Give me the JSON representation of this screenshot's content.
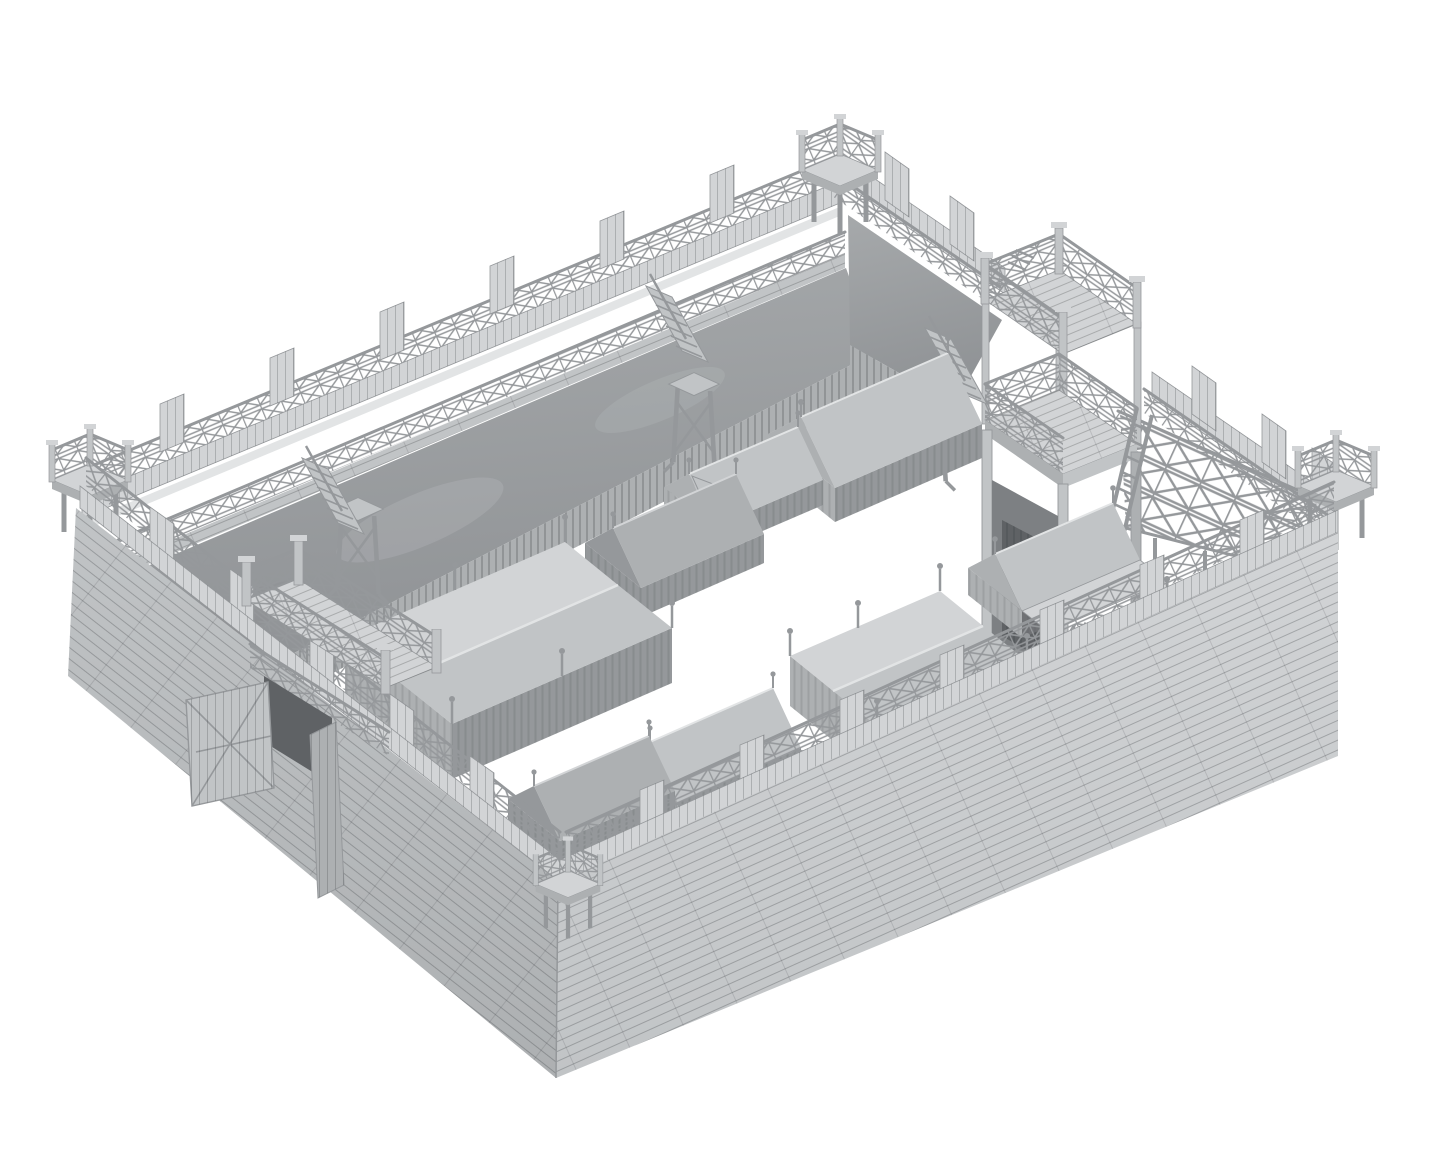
{
  "scene": {
    "title": "Monochrome 3D render of a wooden palisade fort (military camp) with corner watchtowers, two gatehouses, wall walkways and a courtyard of canvas tents",
    "background": "#ffffff",
    "palette": {
      "bg": "#ffffff",
      "c-lighter": "#e2e4e5",
      "c-light": "#d2d4d6",
      "c-base": "#c1c4c6",
      "c-mid": "#adb0b2",
      "c-dim": "#95989b",
      "c-dark": "#7d8083",
      "c-darker": "#5f6265",
      "c-earth": "#a6a9ab",
      "c-earth2": "#8f9295",
      "c-line": "#3c4042"
    },
    "labels": {
      "fort": "Wooden palisade fort 3D model",
      "nw_wall": "North-west rampart wall with walkway railing and palisade",
      "ne_wall": "North-east wall with main gatehouse and timber truss walkway",
      "sw_wall": "South-west plank wall with west gate",
      "se_wall": "South-east plank wall with parapet and walkway railing",
      "rampart": "Earthen rampart slope",
      "palisade": "Vertical stake palisade",
      "parapet": "Plank parapet with raised crenel panels",
      "railing": "Cross-braced walkway railing",
      "main_gatehouse": "Two-storey main gatehouse tower",
      "gate_passage": "Dark gate passage",
      "west_gate": "Two-storey west gate with open doors",
      "gate_door_open": "Open wooden gate door leaning outward",
      "gate_door_inner": "Gate door swung inward",
      "tower_north": "North corner watchtower",
      "tower_west": "West corner watchtower",
      "tower_east": "East corner watchtower",
      "tower_south": "South corner railing platform",
      "access_tower": "Timber access scaffold tower",
      "staircase": "Wooden staircase from walkway",
      "ladder": "Leaning wooden ladder",
      "wall_truss": "Exposed timber truss of elevated walkway",
      "ridge_tent": "Canvas ridge tent",
      "ridge_tent_open": "Canvas ridge tent with open door flap",
      "pavilion_large": "Large draped pavilion tent",
      "pavilion_small": "Draped pavilion tent",
      "awning_tent": "Marquee tent with open front awning",
      "courtyard": "Empty white courtyard ground"
    },
    "inventory": {
      "walls": 4,
      "corner_towers": 4,
      "gatehouses": 2,
      "gate_doors": 2,
      "staircases": 3,
      "access_towers": 3,
      "ladders": 1,
      "ridge_tents": 5,
      "pavilion_tents": 2,
      "awning_tents": 1
    }
  }
}
